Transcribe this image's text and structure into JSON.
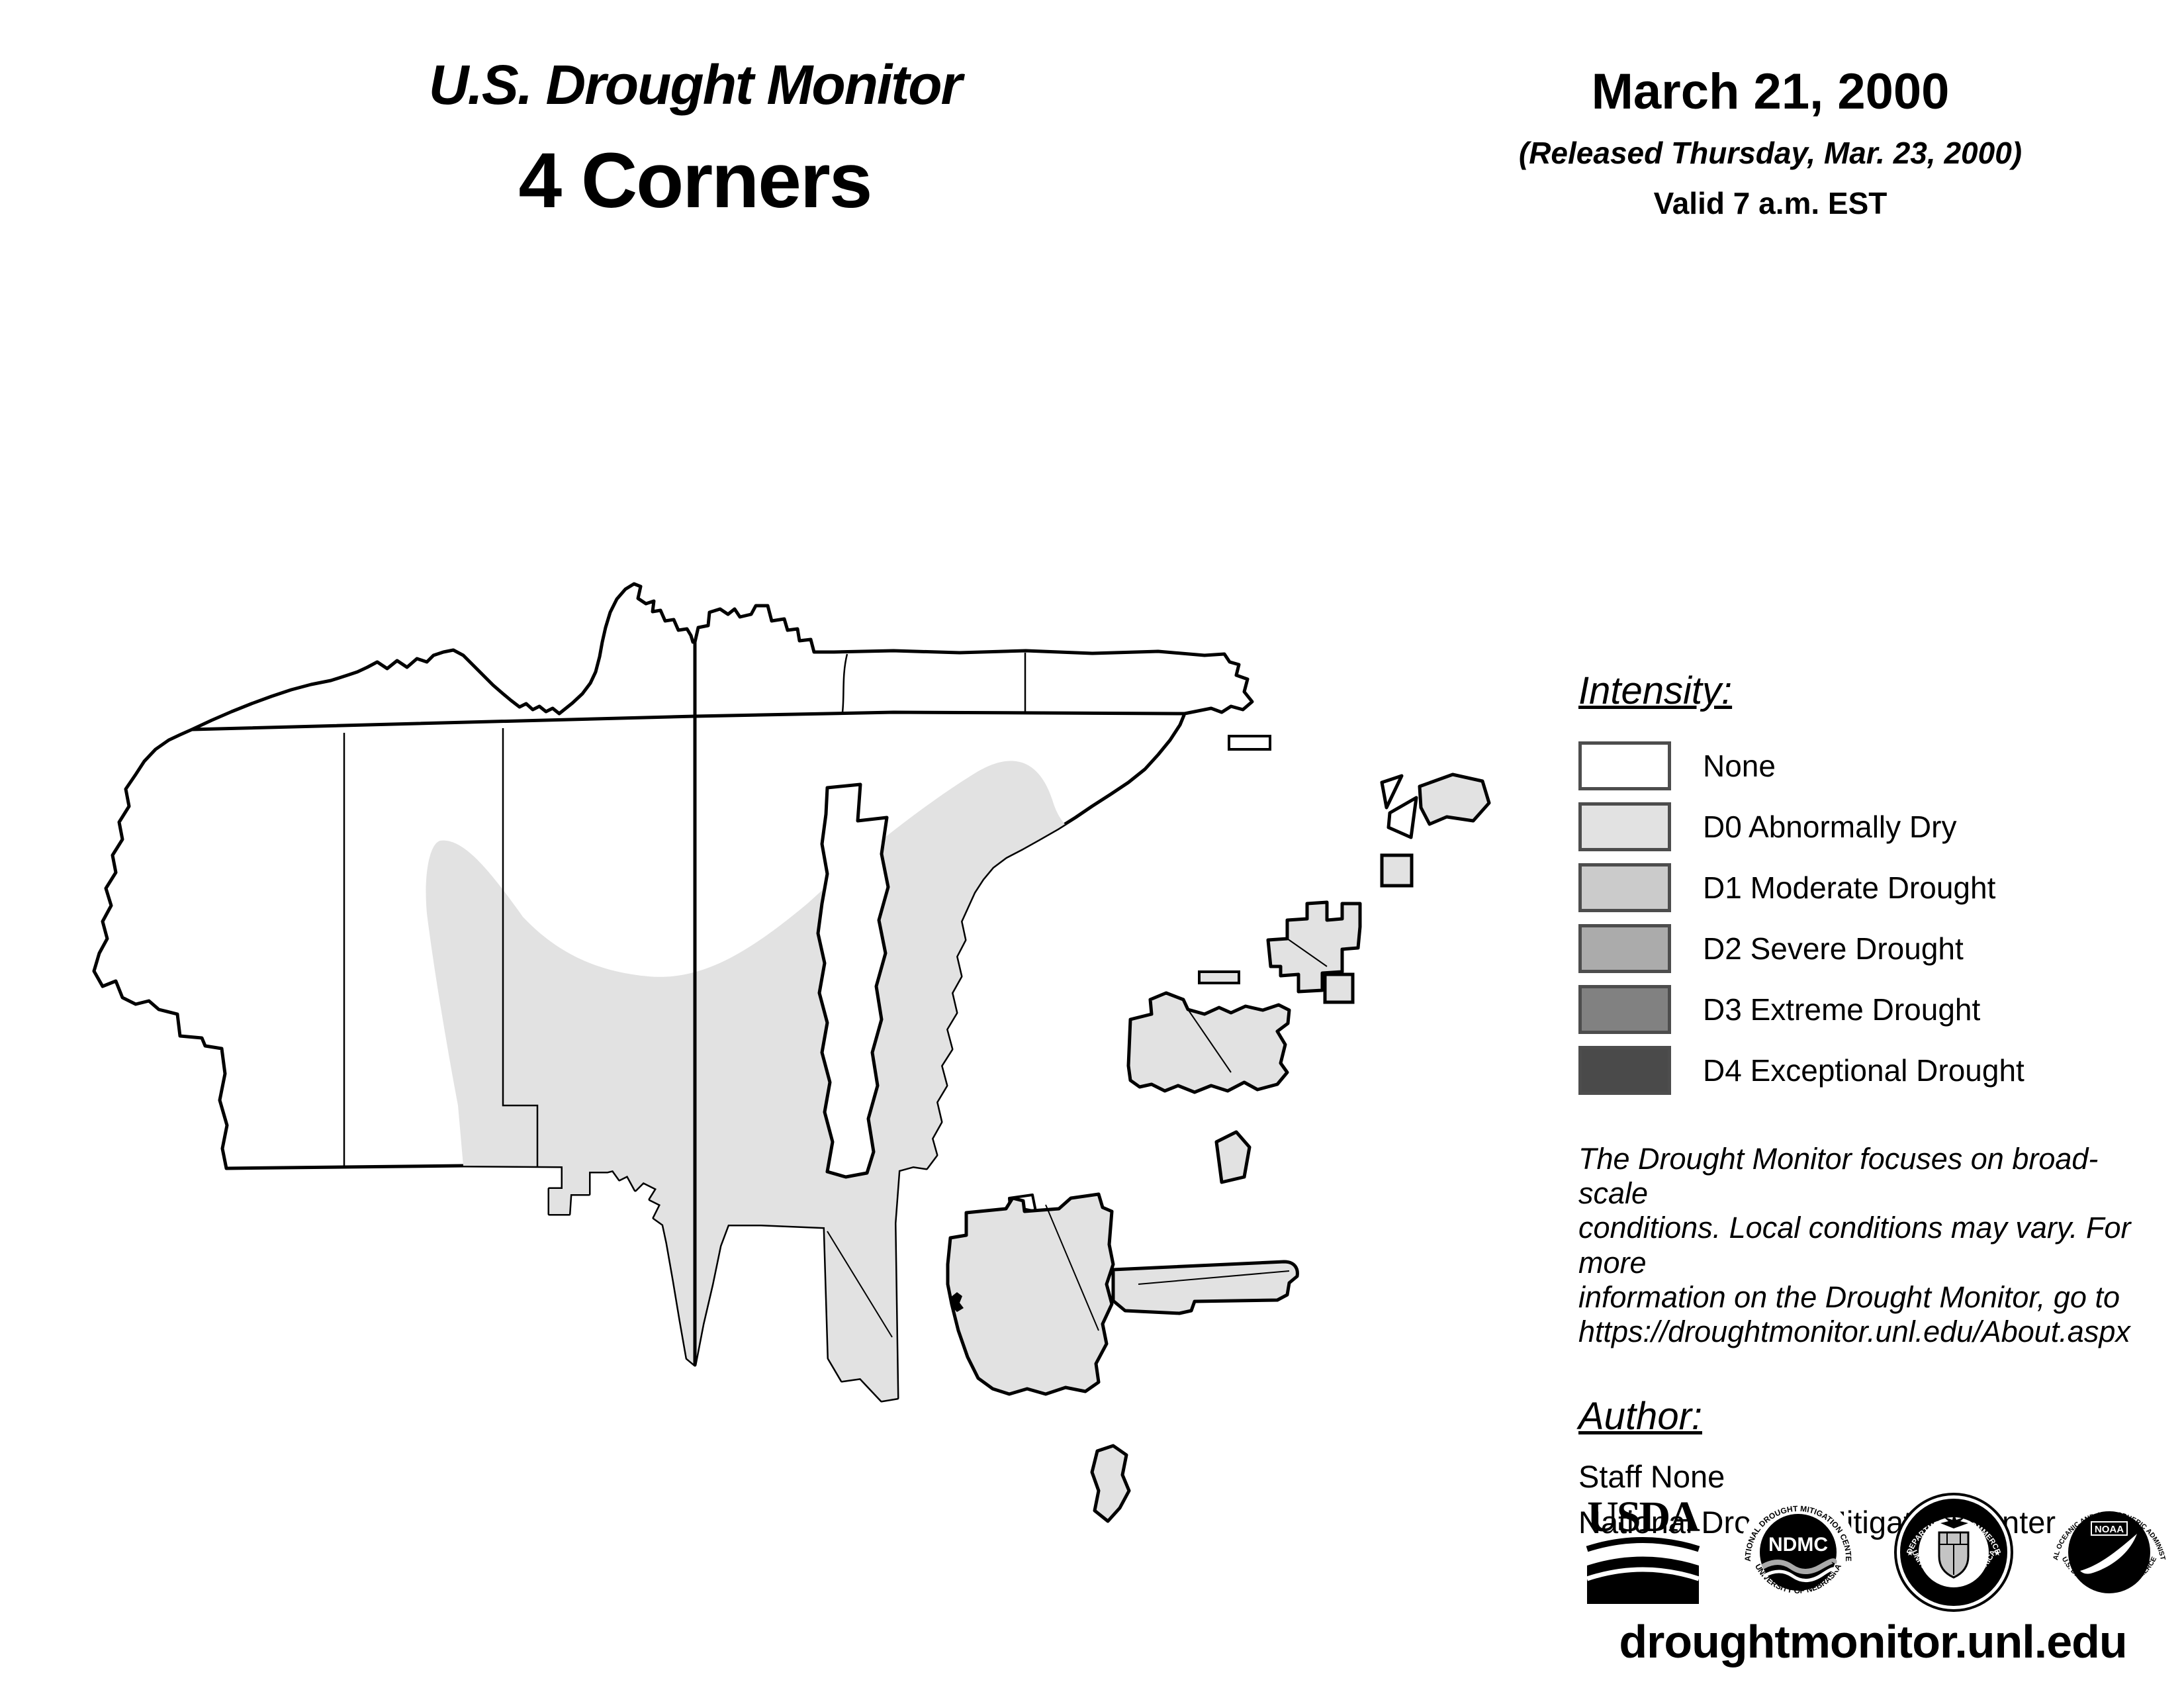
{
  "header": {
    "title": "U.S. Drought Monitor",
    "region": "4 Corners",
    "date": "March 21, 2000",
    "released": "(Released Thursday, Mar. 23, 2000)",
    "valid": "Valid 7 a.m. EST"
  },
  "legend": {
    "heading": "Intensity:",
    "items": [
      {
        "label": "None",
        "color": "#FFFFFF"
      },
      {
        "label": "D0 Abnormally Dry",
        "color": "#E2E2E2"
      },
      {
        "label": "D1 Moderate Drought",
        "color": "#CBCBCB"
      },
      {
        "label": "D2 Severe Drought",
        "color": "#ABABAB"
      },
      {
        "label": "D3 Extreme Drought",
        "color": "#818181"
      },
      {
        "label": "D4 Exceptional Drought",
        "color": "#4A4A4A"
      }
    ]
  },
  "disclaimer": {
    "line1": "The Drought Monitor focuses on broad-scale",
    "line2": "conditions. Local conditions may vary. For more",
    "line3": "information on the Drought Monitor, go to",
    "line4": "https://droughtmonitor.unl.edu/About.aspx"
  },
  "author": {
    "heading": "Author:",
    "name": "Staff None",
    "org": "National Drought Mitigation Center"
  },
  "logos": {
    "usda": {
      "text": "USDA"
    },
    "ndmc": {
      "center": "NDMC",
      "top": "NATIONAL DROUGHT MITIGATION CENTER",
      "bottom": "UNIVERSITY OF NEBRASKA"
    },
    "doc": {
      "top": "DEPARTMENT OF COMMERCE",
      "bottom": "UNITED STATES OF AMERICA"
    },
    "noaa": {
      "center": "NOAA",
      "top": "NATIONAL OCEANIC AND ATMOSPHERIC ADMINISTRATION",
      "bottom": "U.S. DEPARTMENT OF COMMERCE"
    }
  },
  "footer": {
    "url": "droughtmonitor.unl.edu"
  },
  "map": {
    "region_label": "4 Corners (Navajo Nation and surrounding tribal lands)",
    "shading_summary": "D0 Abnormally Dry covers the central and southeastern portion of the region; remainder has no drought designation",
    "colors": {
      "d0_fill": "#E2E2E2",
      "outline": "#000000",
      "none_fill": "#FFFFFF"
    }
  }
}
